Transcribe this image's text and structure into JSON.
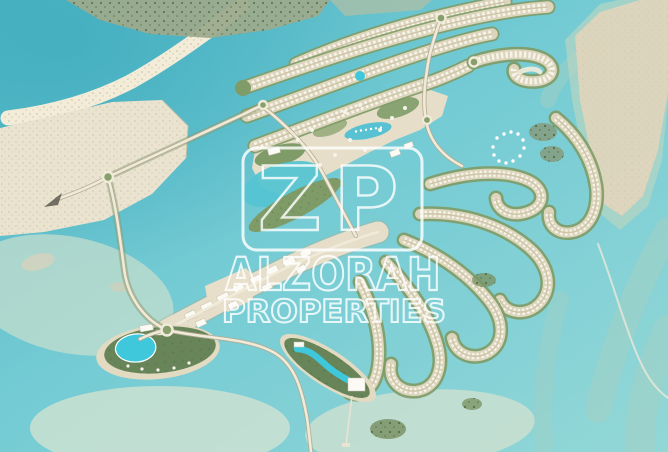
{
  "image": {
    "kind": "aerial-masterplan-map",
    "width_px": 668,
    "height_px": 452,
    "subject": "Waterfront master-planned coastal community with villa peninsulas, lagoons, mangroves, marina and resort islands"
  },
  "watermark": {
    "logo_text": "ZP",
    "title": "ALZORAH",
    "subtitle": "PROPERTIES",
    "color": "#ffffff"
  },
  "palette": {
    "water": "#74cbd4",
    "water_deep": "#4fb5c4",
    "water_light": "#93d7d7",
    "lagoon": "#55c4d2",
    "pool": "#3fc8db",
    "shallow": "#c2dccd",
    "shoal": "#a6d0c2",
    "sand": "#eae3d0",
    "sand_strip": "#ddd5bb",
    "sandbar": "#ded5bc",
    "beach": "#f2ecd9",
    "green": "#7f9c68",
    "green_dark": "#4e6b46",
    "green_resort": "#68855a",
    "mangrove": "#9cab8e",
    "road": "#f0ead9",
    "road_edge": "#b3a98f",
    "villa": "#f6f3ea",
    "building": "#fbfaf5",
    "watermark": "#ffffff"
  },
  "map": {
    "features": [
      {
        "id": "ocean-water",
        "label": "Turquoise sea"
      },
      {
        "id": "shallow-banks",
        "label": "Pale shallow banks"
      },
      {
        "id": "sand-spit",
        "label": "Tidal sand spit (north-west)"
      },
      {
        "id": "mangrove-shore",
        "label": "Mangrove shoreline (top)"
      },
      {
        "id": "sand-flat",
        "label": "White sand flat (west)"
      },
      {
        "id": "offshore-sandbar",
        "label": "Offshore sand bar (east)"
      },
      {
        "id": "shoal-streaks",
        "label": "Sandy shoal streaks (south-east)"
      },
      {
        "id": "villa-peninsulas",
        "label": "Parallel villa peninsulas (north)"
      },
      {
        "id": "beach-hook",
        "label": "Hooked beach peninsula"
      },
      {
        "id": "central-core",
        "label": "Mixed-use central islands"
      },
      {
        "id": "marina-basin",
        "label": "Marina basin with boats"
      },
      {
        "id": "inner-lagoon",
        "label": "Inner lagoon"
      },
      {
        "id": "golf-park",
        "label": "Landscaped park band"
      },
      {
        "id": "boulevard",
        "label": "South-west condo boulevard"
      },
      {
        "id": "serpentine-islands",
        "label": "Serpentine villa fingers (south-east)"
      },
      {
        "id": "west-resort-island",
        "label": "Resort island with lagoon pool (west)"
      },
      {
        "id": "lagoon-resort-island",
        "label": "Resort island with winding pool (south)"
      },
      {
        "id": "mangrove-islets",
        "label": "Mangrove islets"
      },
      {
        "id": "mooring-circle",
        "label": "Mooring buoy circle"
      },
      {
        "id": "road-network",
        "label": "Access roads and roundabouts"
      },
      {
        "id": "entry-arrow",
        "label": "Western entry arrow"
      }
    ]
  }
}
